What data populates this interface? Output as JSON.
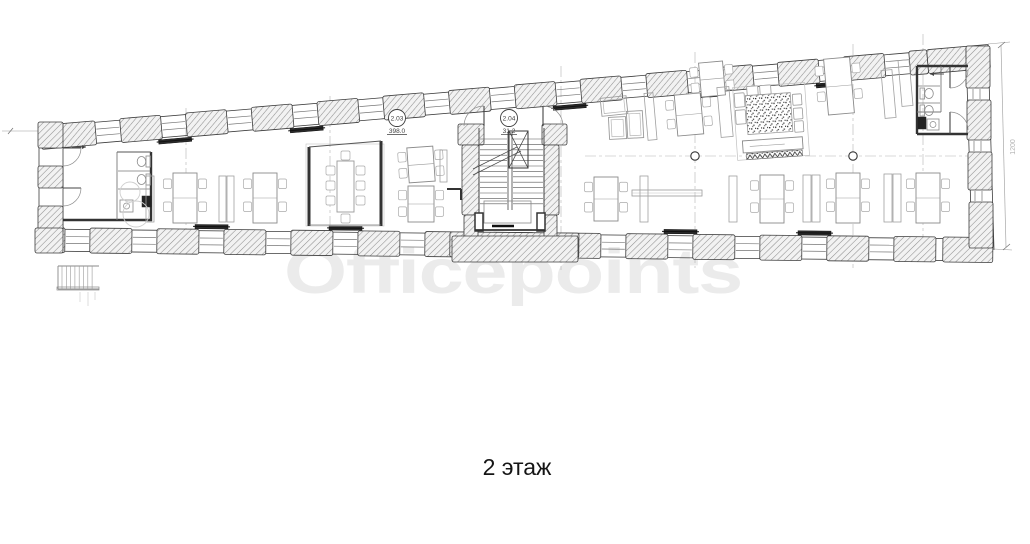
{
  "plan": {
    "caption": "2 этаж",
    "watermark": "Officepoints",
    "room_labels": [
      {
        "number": "2.03",
        "area": "398.0"
      },
      {
        "number": "2.04",
        "area": "31.2"
      }
    ],
    "dimension_right_wall": "1200"
  },
  "colors": {
    "ink": "#3c3c3c",
    "wall_hatch_line": "#8f8f8f",
    "wall_hatch_bg": "#f2f2f2",
    "furniture_line": "#9a9a9a",
    "grid_line": "#b5b5b5",
    "radiator": "#2b2b2b",
    "watermark": "#ebebeb",
    "caption_text": "#151515"
  }
}
